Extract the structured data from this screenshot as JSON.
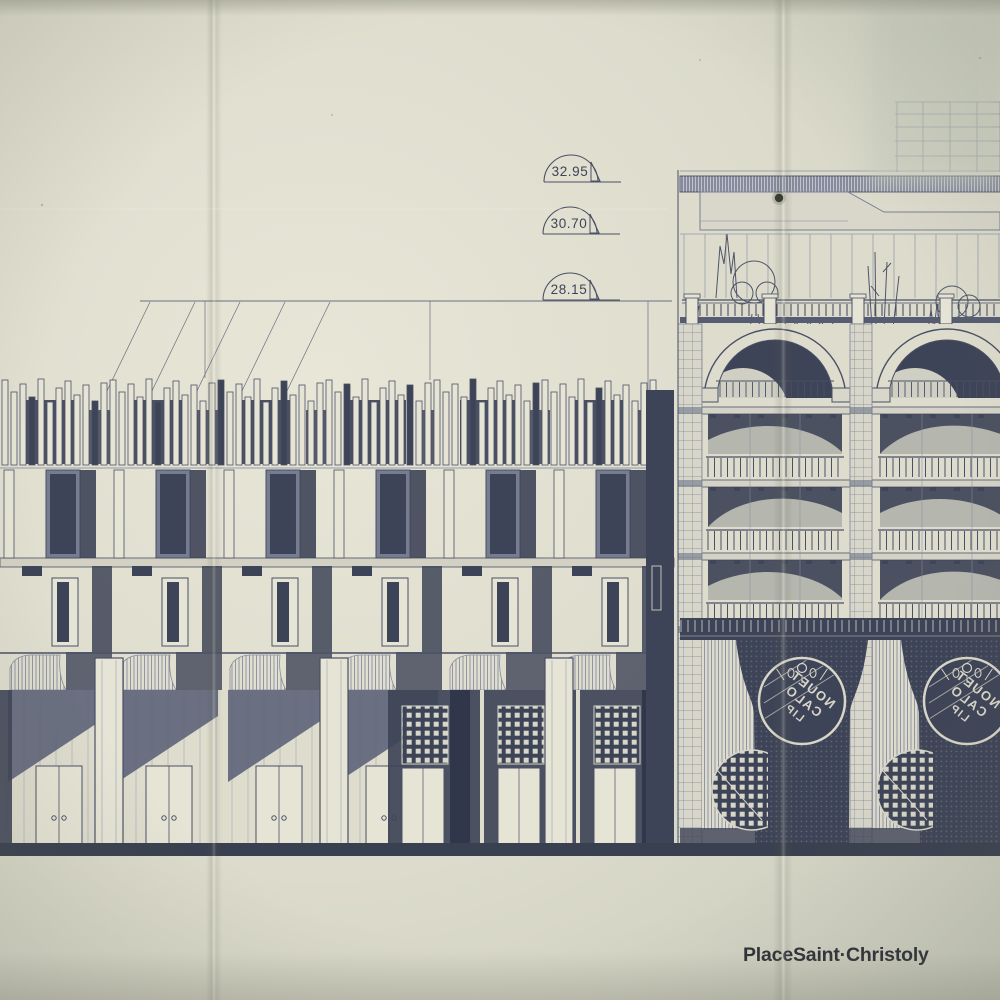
{
  "document": {
    "kind": "architectural facade elevation print, photographed with fold creases",
    "caption": {
      "place": "Place",
      "street_name": "Saint·Christoly"
    },
    "elevation_markers": {
      "m1": "32.95",
      "m2": "30.70",
      "m3": "28.15"
    },
    "signage": {
      "medallion_lines": [
        "NOUET",
        "CALO",
        "LIP"
      ],
      "note": "circular shop medallions on dark piers, lettering mirrored in the print"
    },
    "colors": {
      "paper": "#dedccd",
      "paper_light": "#e6e4d5",
      "paper_shade": "#c8cabb",
      "ink": "#4a5065",
      "ink_dark": "#3e4457",
      "ink_mid": "#7d8398",
      "caption_ink": "#2d3037"
    }
  }
}
